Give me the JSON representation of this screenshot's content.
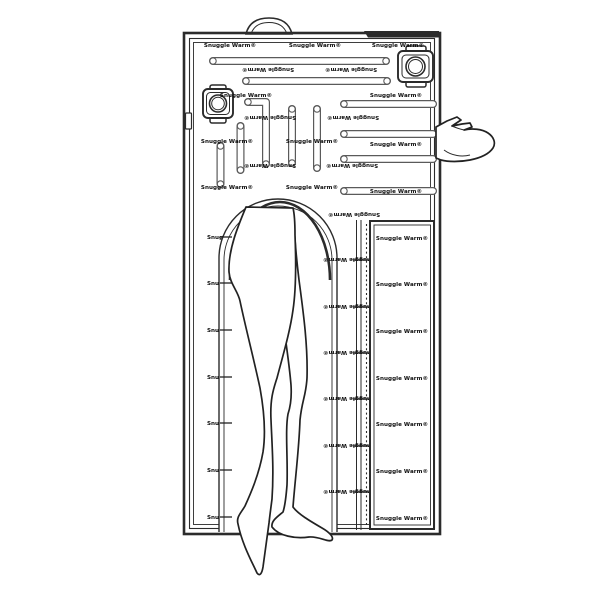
{
  "figure": {
    "brand_label": "Snuggle Warm®",
    "colors": {
      "background": "#ffffff",
      "line": "#2b2b2b",
      "strap_outline": "#5a5a5a",
      "dark_bar": "#2b2b2b"
    }
  }
}
